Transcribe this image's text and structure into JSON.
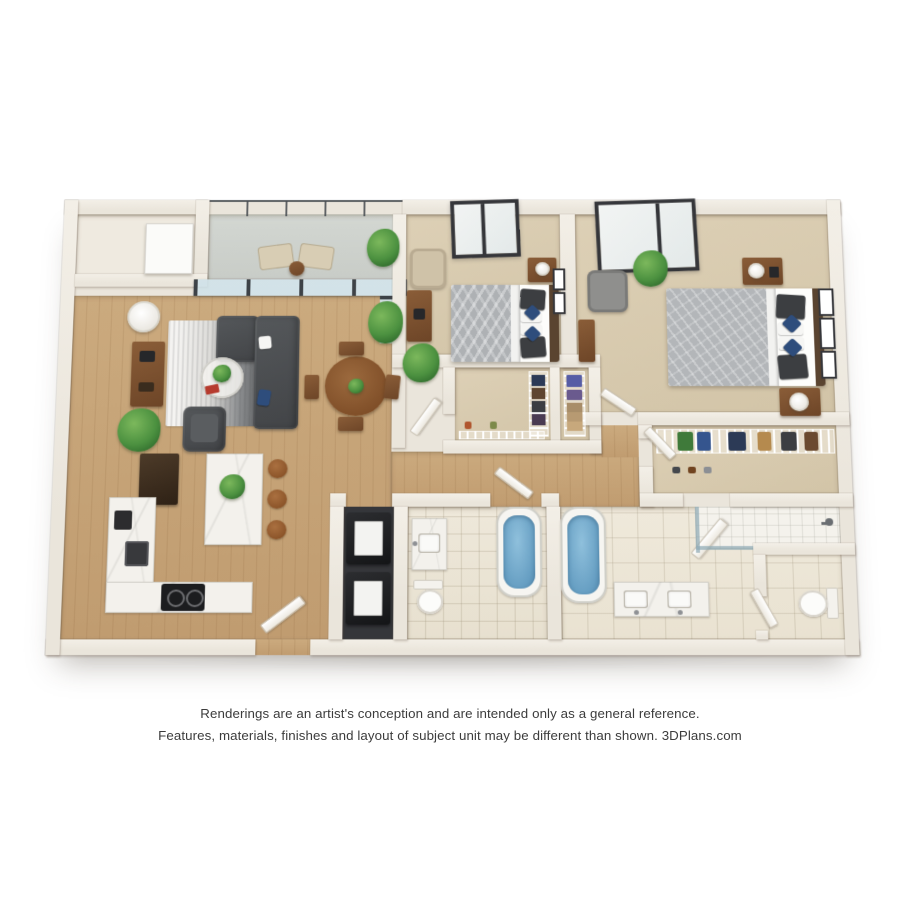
{
  "caption": {
    "line1": "Renderings are an artist's conception and are intended only as a general reference.",
    "line2": "Features, materials, finishes and layout of subject unit may be different than shown.",
    "brand": "3DPlans.com"
  },
  "palette": {
    "page": "#ffffff",
    "wall": "#eae5db",
    "wood": "#c8a77b",
    "carpet": "#d8cbb0",
    "concrete": "#d0d4cf",
    "tile": "#ece6d8",
    "marble": "#f3f1ec",
    "sofa": "#4b4d50",
    "navy": "#2e4d7c",
    "water": "#6ba4c8",
    "plant": "#4c9140",
    "woodFurn": "#7c5232",
    "appliance": "#232427",
    "glassFrame": "#3d4247",
    "text": "#3c3c3c"
  },
  "floorplan": {
    "type": "3D rendered floor plan",
    "unit": {
      "bedrooms": 2,
      "bathrooms": 2
    },
    "rooms": [
      {
        "name": "Balcony",
        "items": [
          "2 lounge chairs",
          "side table",
          "potted plant",
          "glass railing"
        ]
      },
      {
        "name": "Living Room",
        "items": [
          "sectional sofa",
          "armchair",
          "round glass coffee table",
          "gradient area rug",
          "media console",
          "floor lamp",
          "potted plants",
          "sliding glass doors"
        ]
      },
      {
        "name": "Dining Area",
        "items": [
          "round wood table",
          "4 chairs",
          "centerpiece plant"
        ]
      },
      {
        "name": "Kitchen",
        "items": [
          "refrigerator",
          "L-shaped marble counter",
          "sink",
          "cooktop",
          "island with marble top",
          "3 bar stools",
          "plant"
        ]
      },
      {
        "name": "Entry",
        "items": [
          "front door",
          "storage cabinet"
        ]
      },
      {
        "name": "Bedroom 1",
        "items": [
          "bed with gray duvet and blue pillows",
          "nightstands",
          "armchair",
          "desk",
          "plant",
          "window",
          "wall art"
        ]
      },
      {
        "name": "Walk-in Closet 1",
        "items": [
          "wire shelving",
          "hanging clothes",
          "storage bins",
          "shoes"
        ]
      },
      {
        "name": "Bedroom 2",
        "items": [
          "bed with patterned gray duvet and blue pillows",
          "2 nightstands with lamps",
          "armchair",
          "dresser",
          "plant",
          "window",
          "3 framed pictures"
        ]
      },
      {
        "name": "Walk-in Closet 2",
        "items": [
          "wire shelving",
          "hanging clothes",
          "shoes"
        ]
      },
      {
        "name": "Bathroom 1",
        "items": [
          "vanity with sink",
          "toilet",
          "soaking tub"
        ]
      },
      {
        "name": "Bathroom 2",
        "items": [
          "soaking tub",
          "double vanity",
          "walk-in shower",
          "private water closet"
        ]
      },
      {
        "name": "Laundry Closet",
        "items": [
          "washer",
          "dryer"
        ]
      },
      {
        "name": "Hallway",
        "items": []
      }
    ]
  }
}
